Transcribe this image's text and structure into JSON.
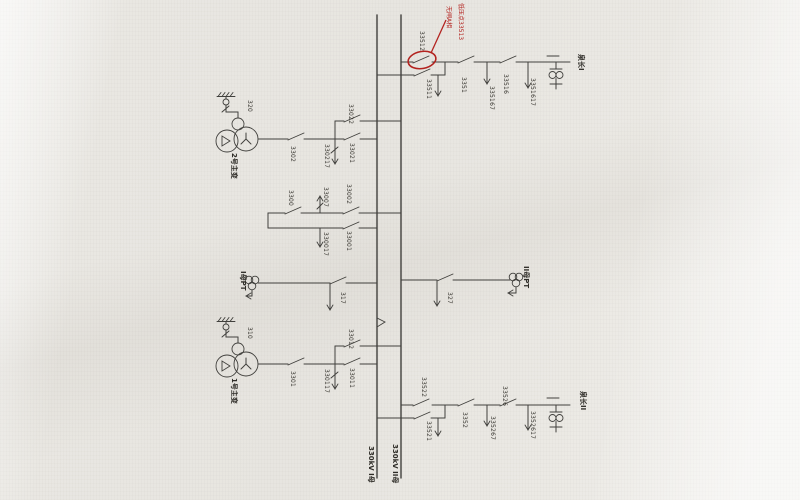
{
  "buses": {
    "bus_i_label": "330kV I母",
    "bus_ii_label": "330kV II母"
  },
  "line_bay_i": {
    "name": "泉长I",
    "bus_ii_disconnector": "33512",
    "bus_i_disconnector": "33511",
    "breaker": "3351",
    "line_disconnector": "33516",
    "breaker_earth_switch": "335167",
    "line_earth_switch": "3351617"
  },
  "transformer_2_bay": {
    "name": "2号主变",
    "neutral_switch": "320",
    "breaker": "3302",
    "bus_ii_disconnector": "33022",
    "bus_i_disconnector": "33021",
    "earth_switch": "330217"
  },
  "bus_coupler_bay": {
    "breaker": "3300",
    "upper_earth_switch": "33007",
    "bus_ii_disconnector": "33002",
    "bus_i_disconnector": "33001",
    "lower_earth_switch": "330017"
  },
  "pt_bay_i": {
    "name": "I母PT",
    "disconnector": "317"
  },
  "pt_bay_ii": {
    "name": "II母PT",
    "disconnector": "327"
  },
  "transformer_1_bay": {
    "name": "1号主变",
    "neutral_switch": "310",
    "breaker": "3301",
    "bus_ii_disconnector": "33012",
    "bus_i_disconnector": "33011",
    "earth_switch": "330117"
  },
  "line_bay_ii": {
    "name": "泉长II",
    "bus_ii_disconnector": "33522",
    "bus_i_disconnector": "33521",
    "breaker": "3352",
    "line_disconnector": "33526",
    "breaker_earth_switch": "335267",
    "line_earth_switch": "3352617"
  },
  "annotation": {
    "note_line1": "低压点33513",
    "note_line2": "无闸A相",
    "color": "#b3231f"
  }
}
